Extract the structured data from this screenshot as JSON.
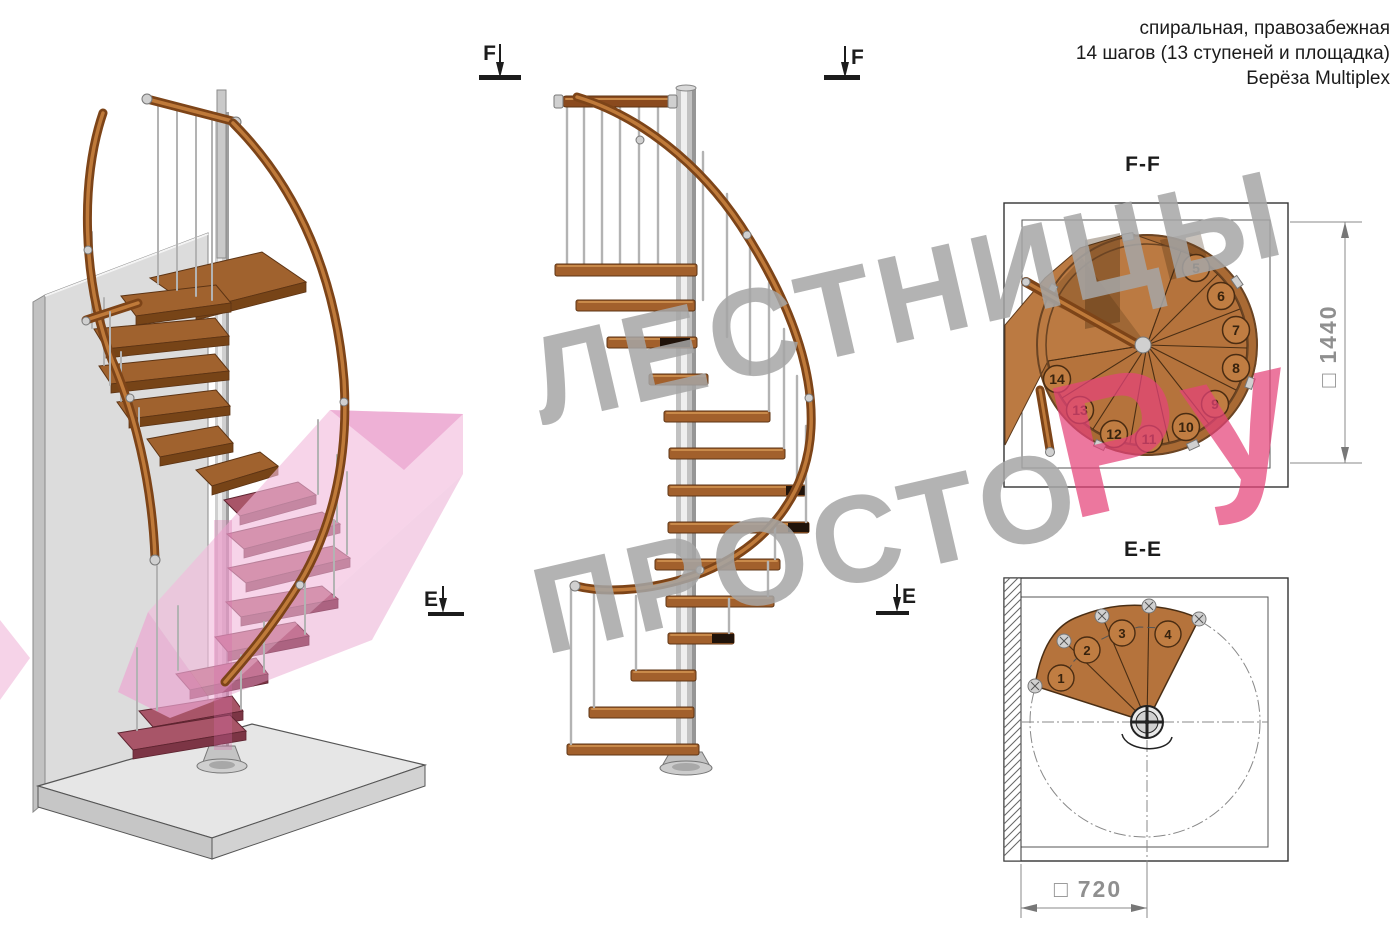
{
  "header": {
    "line1": "спиральная, правозабежная",
    "line2": "14 шагов (13 ступеней и площадка)",
    "line3": "Берёза Multiplex"
  },
  "markers": {
    "f": "F",
    "e": "E"
  },
  "plan_ff": {
    "title": "F-F",
    "dim_symbol": "□",
    "dim_value": "1440",
    "steps": [
      "5",
      "6",
      "7",
      "8",
      "9",
      "10",
      "11",
      "12",
      "13",
      "14"
    ]
  },
  "plan_ee": {
    "title": "E-E",
    "dim_symbol": "□",
    "dim_value": "720",
    "steps": [
      "1",
      "2",
      "3",
      "4"
    ]
  },
  "watermark": {
    "line1": "ЛЕСТНИЦЫ",
    "line2": "ПРОСТО",
    "accent": "Ру"
  },
  "colors": {
    "wood": "#b5733c",
    "wood_dark": "#6b4423",
    "rail": "#7d4418",
    "metal": "#c9c9c9",
    "maroon": "#a85568",
    "section_pink": "#f2b9dc",
    "watermark_gray": "#a6a6a6",
    "watermark_pink": "#e5437a",
    "dim_gray": "#8f8f8f"
  }
}
